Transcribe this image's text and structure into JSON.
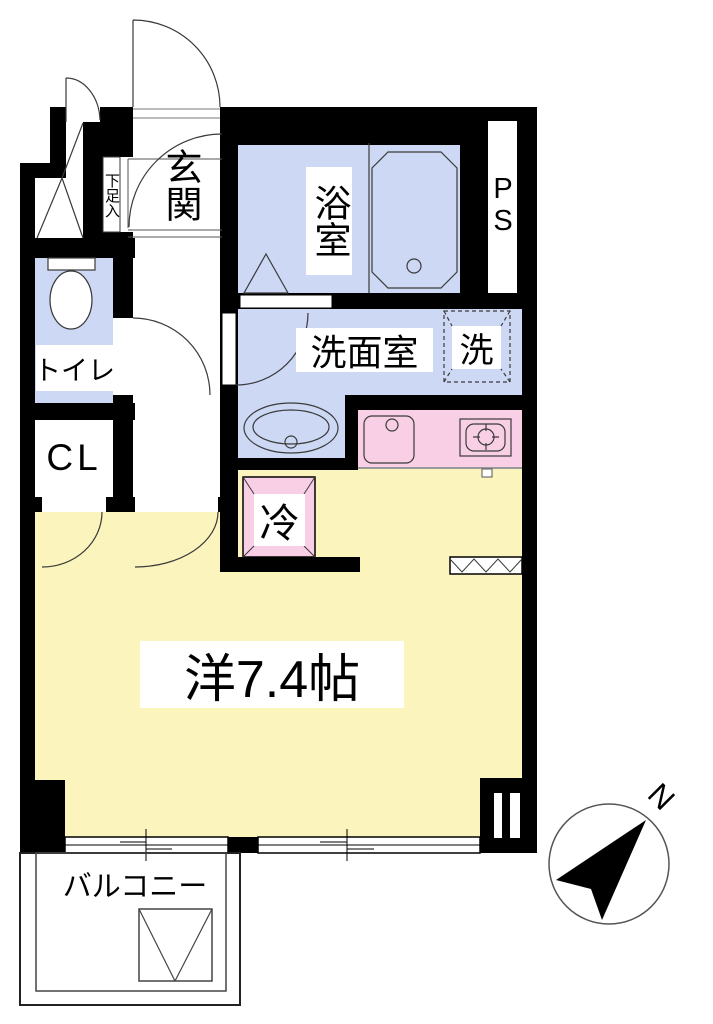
{
  "plan": {
    "rooms": {
      "entrance": {
        "label": "玄関"
      },
      "shoe_cabinet": {
        "label": "下足入"
      },
      "bathroom": {
        "label": "浴室"
      },
      "pipe_space": {
        "label": "PS"
      },
      "washroom": {
        "label": "洗面室"
      },
      "washer_space": {
        "label": "洗"
      },
      "toilet": {
        "label": "トイレ"
      },
      "closet": {
        "label": "CL"
      },
      "refrigerator_space": {
        "label": "冷"
      },
      "main_room": {
        "label": "洋7.4帖"
      },
      "balcony": {
        "label": "バルコニー"
      }
    },
    "compass": {
      "north": "N"
    },
    "colors": {
      "wall": "#000000",
      "wet_area_blue": "#cdd9f4",
      "room_yellow": "#fbf4bd",
      "kitchen_pink": "#f8cfe4",
      "line": "#3a3a3a",
      "floor_white": "#ffffff"
    }
  }
}
